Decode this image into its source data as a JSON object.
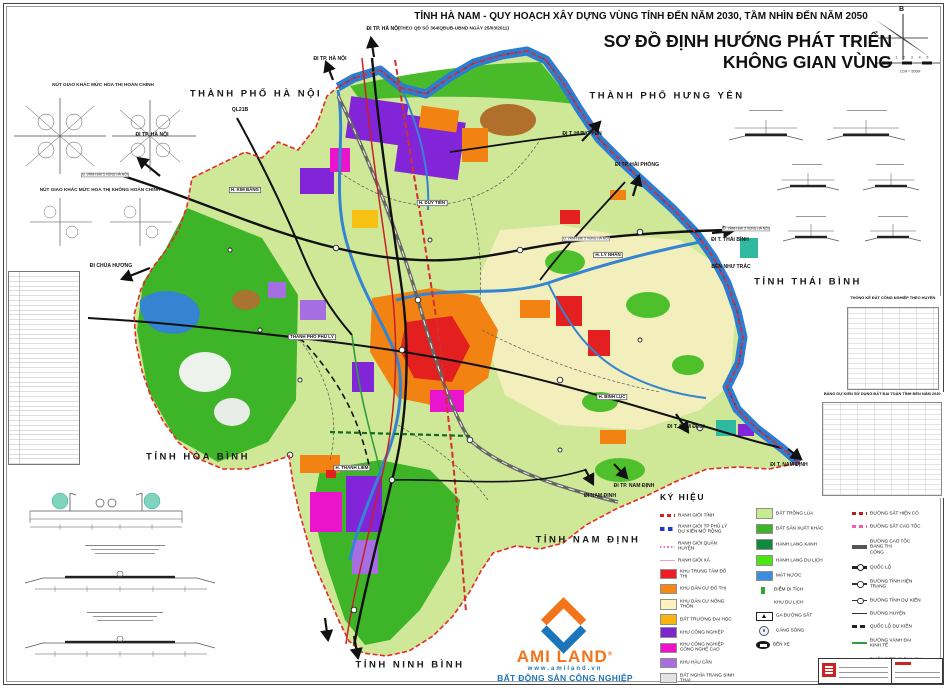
{
  "header": {
    "title": "TỈNH HÀ NAM - QUY HOẠCH  XÂY DỰNG VÙNG TỈNH ĐẾN NĂM 2030, TẦM NHÌN ĐẾN NĂM 2050",
    "decision": "(THEO QĐ SỐ 364/QĐUB-UBND NGÀY 25/03/2011)",
    "map_name_line1": "SƠ ĐỒ ĐỊNH HƯỚNG PHÁT TRIỂN",
    "map_name_line2": "KHÔNG GIAN VÙNG"
  },
  "compass": {
    "north": "B",
    "scale_ticks": [
      "0",
      "1",
      "2",
      "3",
      "4",
      "5"
    ],
    "scale_note": "1CM = 500M"
  },
  "inset_titles": {
    "interchange_full": "NÚT GIAO KHÁC MỨC HOA THỊ HOÀN CHỈNH",
    "interchange_partial": "NÚT GIAO KHÁC MỨC HOA THỊ KHÔNG HOÀN CHỈNH"
  },
  "side_tables": {
    "industry_title": "THỐNG KÊ ĐẤT CÔNG NGHIỆP THEO HUYỆN",
    "landuse_title": "BẢNG DỰ KIẾN SỬ DỤNG ĐẤT ĐAI TOÀN TỈNH ĐẾN NĂM 2030"
  },
  "map": {
    "province_labels": [
      {
        "text": "THÀNH PHỐ HÀ NỘI",
        "x": 256,
        "y": 94
      },
      {
        "text": "THÀNH PHỐ HƯNG YÊN",
        "x": 667,
        "y": 96
      },
      {
        "text": "TỈNH THÁI BÌNH",
        "x": 808,
        "y": 282
      },
      {
        "text": "TỈNH HÒA BÌNH",
        "x": 198,
        "y": 457
      },
      {
        "text": "TỈNH NAM ĐỊNH",
        "x": 588,
        "y": 540
      },
      {
        "text": "TỈNH NINH BÌNH",
        "x": 410,
        "y": 665
      }
    ],
    "direction_labels": [
      {
        "text": "ĐI TP. HÀ NỘI",
        "x": 383,
        "y": 29
      },
      {
        "text": "ĐI TP. HÀ NỘI",
        "x": 330,
        "y": 59
      },
      {
        "text": "ĐI TP. HÀ NỘI",
        "x": 152,
        "y": 135
      },
      {
        "text": "QL21B",
        "x": 240,
        "y": 110
      },
      {
        "text": "ĐI CHÙA HƯƠNG",
        "x": 111,
        "y": 266
      },
      {
        "text": "ĐI T. HƯNG YÊN",
        "x": 582,
        "y": 134
      },
      {
        "text": "ĐI TP. HẢI PHÒNG",
        "x": 637,
        "y": 165
      },
      {
        "text": "ĐI T. THÁI BÌNH",
        "x": 730,
        "y": 240
      },
      {
        "text": "BẾN NHƯ TRÁC",
        "x": 731,
        "y": 267
      },
      {
        "text": "ĐI T. NAM ĐỊNH",
        "x": 686,
        "y": 427
      },
      {
        "text": "ĐI T. NAM ĐỊNH",
        "x": 789,
        "y": 465
      },
      {
        "text": "ĐI TP. NAM ĐỊNH",
        "x": 634,
        "y": 486
      },
      {
        "text": "ĐI NAM ĐỊNH",
        "x": 600,
        "y": 496
      }
    ],
    "district_labels": [
      {
        "text": "H. KIM BẢNG",
        "x": 245,
        "y": 190
      },
      {
        "text": "H. DUY TIÊN",
        "x": 432,
        "y": 203
      },
      {
        "text": "THÀNH PHỐ PHỦ LÝ",
        "x": 312,
        "y": 337
      },
      {
        "text": "H. LÝ NHÂN",
        "x": 608,
        "y": 255
      },
      {
        "text": "H. BÌNH LỤC",
        "x": 612,
        "y": 397
      },
      {
        "text": "H. THANH LIÊM",
        "x": 352,
        "y": 468
      }
    ],
    "road_ribbons": [
      {
        "text": "Đ. VÀNH ĐAI 5 VÙNG HÀ NỘI",
        "x": 105,
        "y": 175
      },
      {
        "text": "Đ. VÀNH ĐAI 5 VÙNG HÀ NỘI",
        "x": 746,
        "y": 229
      },
      {
        "text": "Đ. VÀNH ĐAI 5 VÙNG HÀ NỘI",
        "x": 586,
        "y": 239
      }
    ]
  },
  "legend": {
    "title": "KÝ HIỆU",
    "columns": [
      {
        "items": [
          {
            "sw": "dash",
            "color": "#d62028",
            "label": "RANH GIỚI TỈNH"
          },
          {
            "sw": "squares",
            "color": "#2637c8",
            "label": "RANH GIỚI TP PHỦ LÝ\nDỰ KIẾN MỞ RỘNG"
          },
          {
            "sw": "dots",
            "color": "#e87bd0",
            "label": "RANH GIỚI QUẬN HUYỆN"
          },
          {
            "sw": "thin",
            "color": "#f0a0c8",
            "label": "RANH GIỚI XÃ"
          },
          {
            "sw": "fill",
            "color": "#ee1c25",
            "label": "KHU TRUNG TÂM ĐÔ THỊ"
          },
          {
            "sw": "fill",
            "color": "#f68712",
            "label": "KHU DÂN CƯ ĐÔ THỊ"
          },
          {
            "sw": "fill",
            "color": "#fdf3c0",
            "label": "KHU DÂN CƯ NÔNG THÔN"
          },
          {
            "sw": "fill",
            "color": "#f9b410",
            "label": "ĐẤT TRƯỜNG ĐẠI HỌC"
          },
          {
            "sw": "fill",
            "color": "#7d26cd",
            "label": "KHU CÔNG NGHIỆP"
          },
          {
            "sw": "fill",
            "color": "#f011c8",
            "label": "KHU CÔNG NGHIỆP\nCÔNG NGHỆ CAO"
          },
          {
            "sw": "fill",
            "color": "#a86ee0",
            "label": "KHU HẬU CẦN"
          },
          {
            "sw": "fill",
            "color": "#e3e3e3",
            "label": "ĐẤT NGHĨA TRANG SINH THÁI"
          }
        ]
      },
      {
        "items": [
          {
            "sw": "fill",
            "color": "#c7ec8e",
            "label": "ĐẤT TRỒNG LÚA"
          },
          {
            "sw": "fill",
            "color": "#3db528",
            "label": "ĐẤT SẢN XUẤT KHÁC"
          },
          {
            "sw": "fill",
            "color": "#0f8a3c",
            "label": "HÀNH LANG XANH"
          },
          {
            "sw": "fill",
            "color": "#4be512",
            "label": "HÀNH LANG DU LỊCH"
          },
          {
            "sw": "fill",
            "color": "#3b8ede",
            "label": "MẶT NƯỚC"
          },
          {
            "sw": "smallfill",
            "color": "#2faa30",
            "label": "ĐIỂM DI TÍCH"
          },
          {
            "sw": "none",
            "color": "#ffffff",
            "label": "KHU DU LỊCH"
          },
          {
            "sw": "station",
            "color": "#222222",
            "label": "GA ĐƯỜNG SẮT"
          },
          {
            "sw": "port",
            "color": "#556677",
            "label": "CẢNG SÔNG"
          },
          {
            "sw": "bus",
            "color": "#1a1a1a",
            "label": "BẾN XE"
          }
        ]
      },
      {
        "items": [
          {
            "sw": "dash",
            "color": "#c01820",
            "label": "ĐƯỜNG SẮT HIỆN CÓ"
          },
          {
            "sw": "dash",
            "color": "#ef5fb0",
            "label": "ĐƯỜNG SẮT CAO TỐC"
          },
          {
            "sw": "thick",
            "color": "#555555",
            "label": "ĐƯỜNG CAO TỐC ĐANG THI\nCÔNG"
          },
          {
            "sw": "linecircle",
            "color": "#222222",
            "label": "QUỐC LỘ"
          },
          {
            "sw": "linecircle-thin",
            "color": "#333333",
            "label": "ĐƯỜNG TỈNH HIỆN TRẠNG"
          },
          {
            "sw": "linecircle-thin",
            "color": "#333333",
            "label": "ĐƯỜNG TỈNH DỰ KIẾN"
          },
          {
            "sw": "thin",
            "color": "#333333",
            "label": "ĐƯỜNG HUYỆN"
          },
          {
            "sw": "dashthick",
            "color": "#222222",
            "label": "QUỐC LỘ DỰ KIẾN"
          },
          {
            "sw": "line2",
            "color": "#2e9e3e",
            "label": "ĐƯỜNG VÀNH ĐAI KINH TẾ"
          },
          {
            "sw": "line2",
            "color": "#156a2a",
            "label": "ĐƯỜNG TRỤC DU LỊCH"
          },
          {
            "sw": "line2",
            "color": "#e03030",
            "label": "ĐƯỜNG SẮT BẮC NAM"
          }
        ]
      }
    ]
  },
  "logo": {
    "name": "AMI LAND",
    "reg": "®",
    "website": "www.amiland.vn",
    "tagline": "BẤT ĐỘNG SẢN CÔNG NGHIỆP",
    "orange": "#F4741B",
    "blue": "#1B75BB"
  }
}
